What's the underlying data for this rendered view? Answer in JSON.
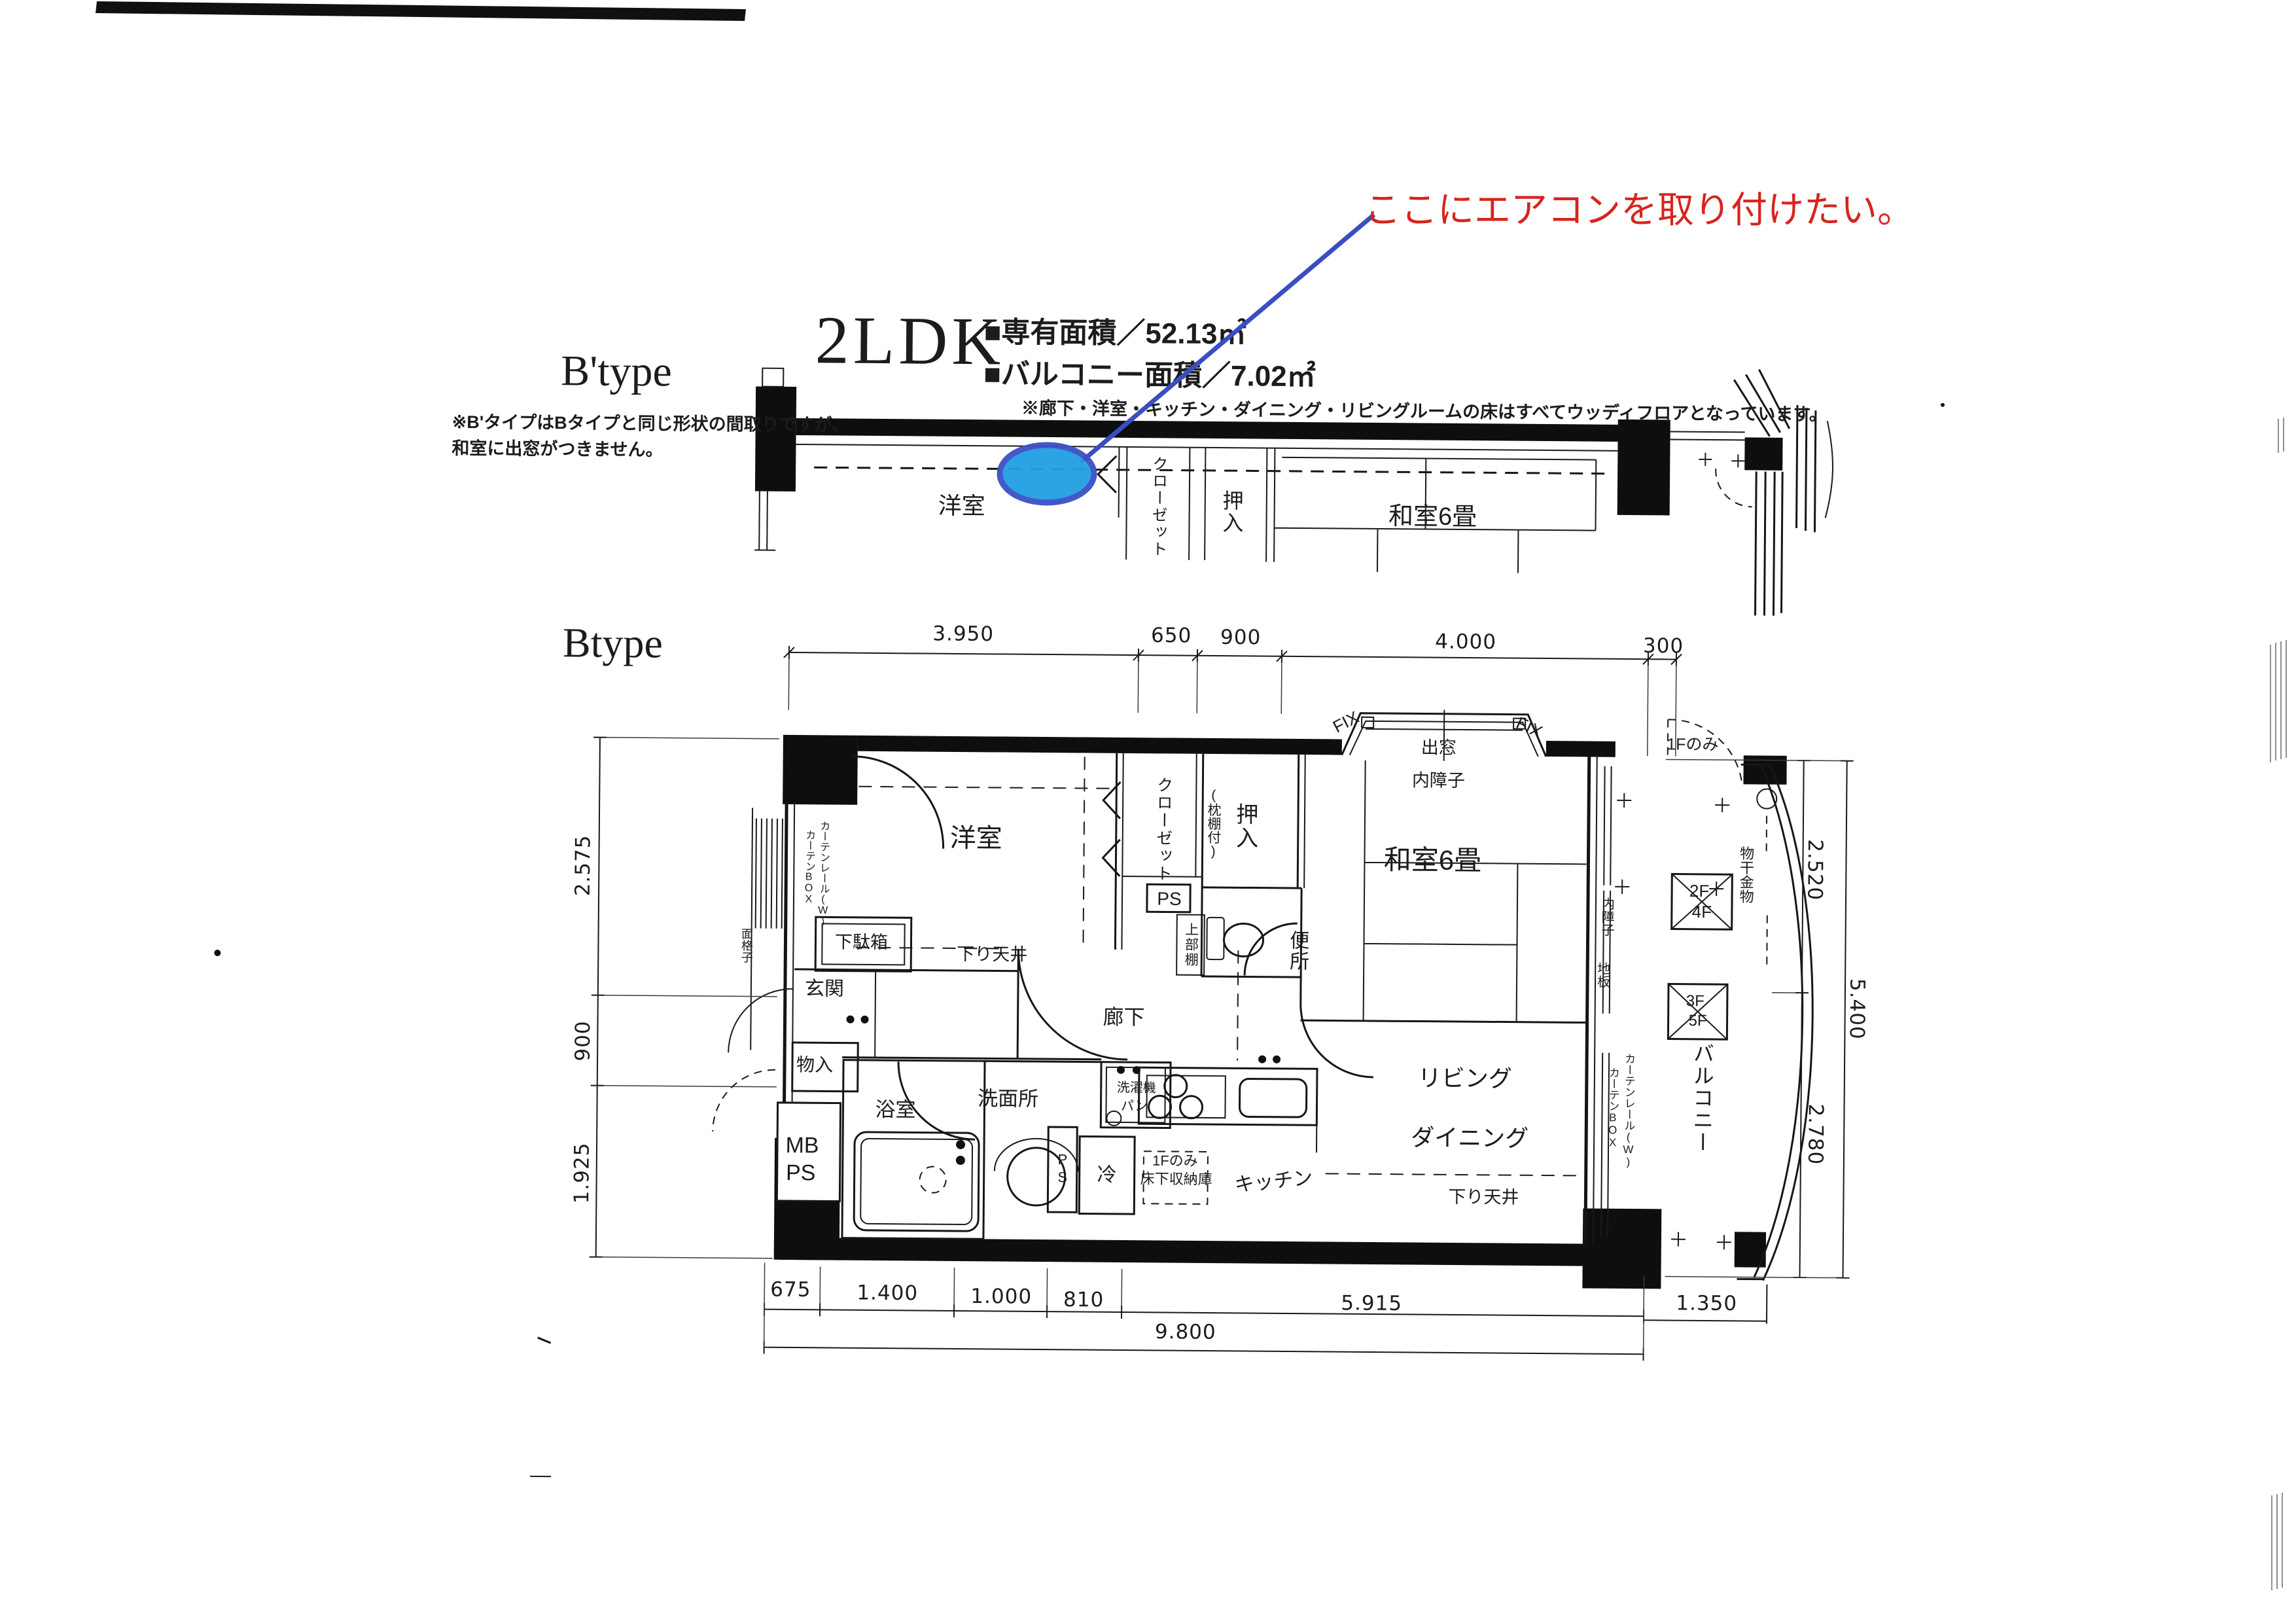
{
  "annotation": {
    "text": "ここにエアコンを取り付けたい。",
    "text_color": "#d6251d",
    "line_color": "#3a4ec2",
    "marker_fill": "#219fe2",
    "marker_stroke": "#3c50c5"
  },
  "header": {
    "plan_type": "2LDK",
    "exclusive_area": "■専有面積／52.13㎡",
    "balcony_area": "■バルコニー面積／7.02㎡",
    "floor_note": "※廊下・洋室・キッチン・ダイニング・リビングルームの床はすべてウッディフロアとなっています。"
  },
  "btype_small": {
    "title": "B'type",
    "note_line1": "※B'タイプはBタイプと同じ形状の間取りですが、",
    "note_line2": "和室に出窓がつきません。",
    "labels": {
      "western_room": "洋室",
      "closet": "クローゼット",
      "oshiire": "押入",
      "japanese_room": "和室6畳"
    }
  },
  "btype_main": {
    "title": "Btype",
    "labels": {
      "western_room": "洋室",
      "closet": "クローゼット",
      "ps_upper": "PS",
      "oshiire": "押入",
      "oshiire_note": "(枕棚付)",
      "japanese_room": "和室6畳",
      "bay_window": "出窓",
      "inner_shoji": "内障子",
      "fix_left": "FIX",
      "fix_right": "FIX",
      "upper_shelf": "上部棚",
      "toilet": "便所",
      "shoe_box": "下駄箱",
      "dropped_ceiling_hall": "下り天井",
      "entrance": "玄関",
      "hallway": "廊下",
      "storage": "物入",
      "mb": "MB",
      "ps": "PS",
      "bathroom": "浴室",
      "washroom": "洗面所",
      "washer_line1": "洗濯機",
      "washer_line2": "パン",
      "ps_small": "PS",
      "fridge": "冷",
      "underfloor_line1": "1Fのみ",
      "underfloor_line2": "床下収納庫",
      "kitchen": "キッチン",
      "living": "リビング",
      "dining": "ダイニング",
      "dropped_ceiling_ld": "下り天井",
      "curtain_rail": "カーテンレール(W)",
      "curtain_box": "カーテンBOX",
      "curtain_box_left": "カーテンBOX",
      "curtain_rail_left": "カーテンレール(W)",
      "inner_shoji2": "内障子",
      "floor_board": "地板",
      "balcony": "バルコニー",
      "laundry_pole": "物干金物",
      "floor_2f": "2F",
      "floor_4f": "4F",
      "floor_3f": "3F",
      "floor_5f": "5F",
      "first_floor_only": "1Fのみ",
      "lattice": "面格子"
    }
  },
  "dimensions": {
    "top": [
      "3.950",
      "650",
      "900",
      "4.000",
      "300"
    ],
    "left": [
      "2.575",
      "900",
      "1.925"
    ],
    "right": [
      "2.520",
      "5.400",
      "2.780"
    ],
    "bottom_upper": [
      "675",
      "1.400",
      "1.000",
      "810",
      "5.915",
      "1.350"
    ],
    "bottom_total": "9.800"
  }
}
